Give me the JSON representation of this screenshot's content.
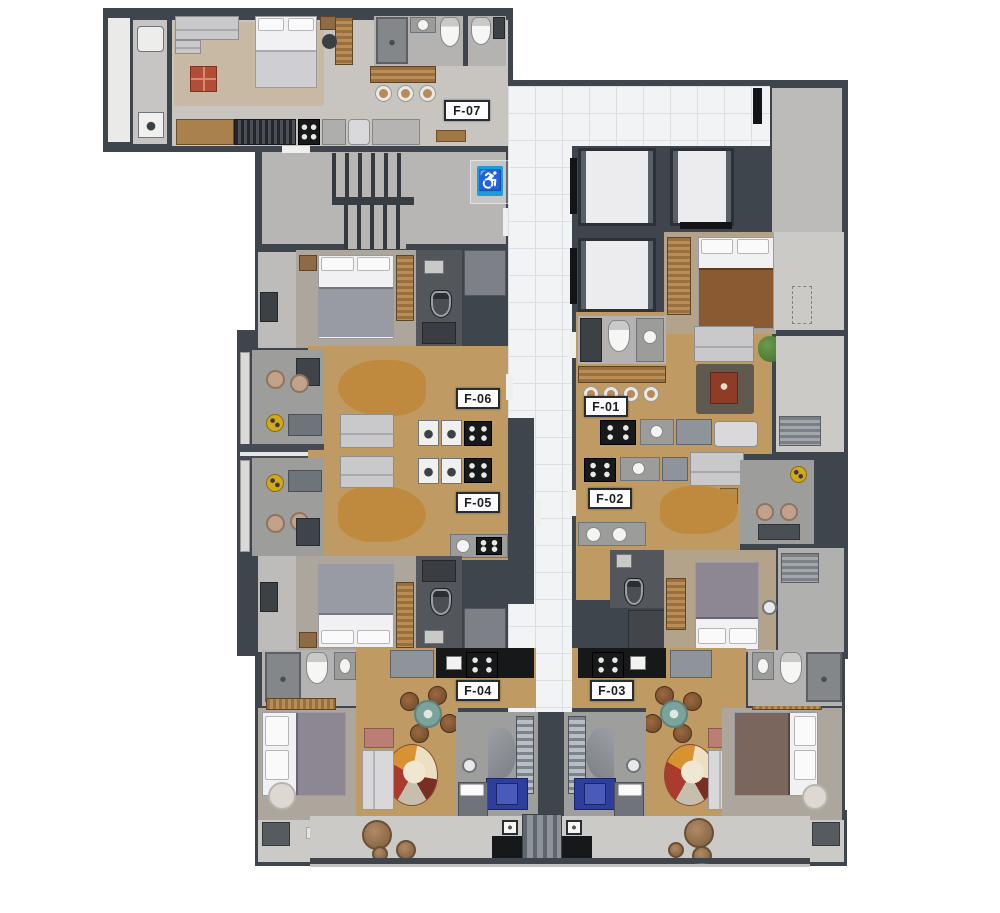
{
  "title": "Residential building typical floor plan",
  "units": {
    "f01": {
      "label": "F-01"
    },
    "f02": {
      "label": "F-02"
    },
    "f03": {
      "label": "F-03"
    },
    "f04": {
      "label": "F-04"
    },
    "f05": {
      "label": "F-05"
    },
    "f06": {
      "label": "F-06"
    },
    "f07": {
      "label": "F-07"
    }
  },
  "icons": {
    "accessibility": "♿"
  },
  "colors": {
    "wall": "#3e454d",
    "wood": "#bf9a63",
    "concrete": "#c6c5c3",
    "tile": "#f2f3f5",
    "tile_line": "#dcdee1",
    "balcony": "#9d9d9b",
    "balcony_light": "#cbcac7",
    "bath_dark": "#53575c",
    "blue": "#1e9cd7",
    "chair_blue": "#2e3e9e",
    "rug_tan": "#c08a3e",
    "rug_beige": "#c7b9a4",
    "red": "#b24e37"
  }
}
